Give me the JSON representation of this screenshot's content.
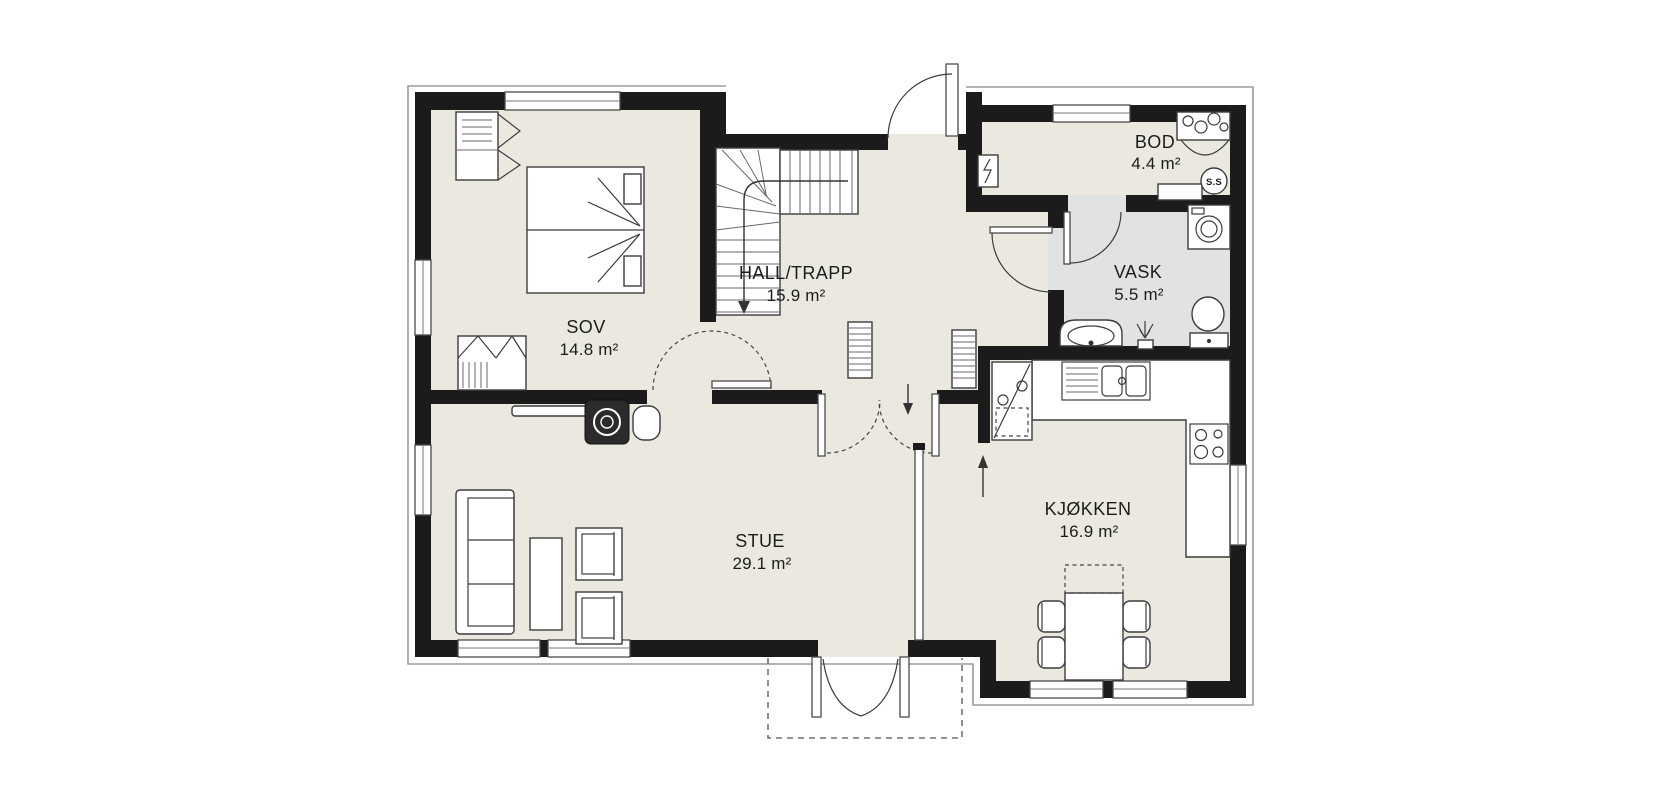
{
  "plan": {
    "type": "floor-plan",
    "rooms": [
      {
        "id": "sov",
        "name": "SOV",
        "area": "14.8 m²"
      },
      {
        "id": "hall",
        "name": "HALL/TRAPP",
        "area": "15.9 m²"
      },
      {
        "id": "bod",
        "name": "BOD",
        "area": "4.4 m²"
      },
      {
        "id": "vask",
        "name": "VASK",
        "area": "5.5 m²"
      },
      {
        "id": "stue",
        "name": "STUE",
        "area": "29.1 m²"
      },
      {
        "id": "kjokken",
        "name": "KJØKKEN",
        "area": "16.9 m²"
      }
    ],
    "labels": {
      "chimney": "S.S"
    },
    "colors": {
      "wall": "#1b1b1b",
      "floor": "#ebe9df",
      "wet_room_floor": "#e1e2e2",
      "exterior_outline": "#9b9b9b",
      "fixture_stroke": "#3c3c3c",
      "background": "#ffffff"
    },
    "fixtures": [
      "bed",
      "wardrobe",
      "wardrobe",
      "stairs",
      "radiator",
      "radiator",
      "electrical-panel",
      "water-heater-bench",
      "chimney",
      "washing-machine",
      "vanity-sink",
      "floor-drain",
      "toilet",
      "kitchen-counter",
      "cooktop",
      "kitchen-sink",
      "fridge-freezer",
      "dining-table",
      "dining-chairs",
      "sofa",
      "coffee-table",
      "armchair",
      "armchair",
      "tv-bench",
      "wood-stove",
      "side-table",
      "entry-door",
      "sov-door",
      "vask-door",
      "bod-door",
      "stue-double-door",
      "veranda-double-door",
      "veranda"
    ]
  }
}
